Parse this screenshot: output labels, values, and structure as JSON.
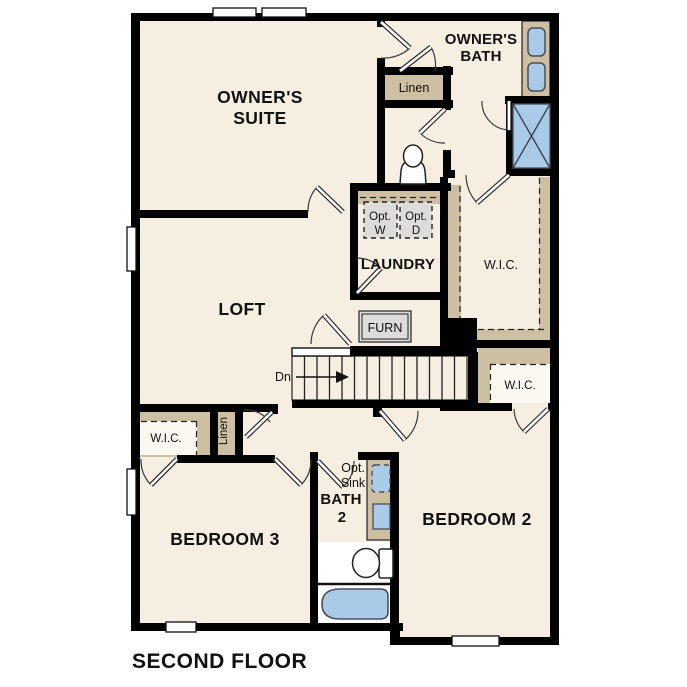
{
  "title": "SECOND FLOOR",
  "rooms": {
    "owners_suite": {
      "line1": "OWNER'S",
      "line2": "SUITE"
    },
    "owners_bath": {
      "line1": "OWNER'S",
      "line2": "BATH"
    },
    "loft": {
      "label": "LOFT"
    },
    "laundry": {
      "label": "LAUNDRY"
    },
    "bedroom2": {
      "label": "BEDROOM 2"
    },
    "bedroom3": {
      "label": "BEDROOM 3"
    },
    "bath2": {
      "line1": "BATH",
      "line2": "2"
    },
    "wic_owners": {
      "label": "W.I.C."
    },
    "wic_bedroom2": {
      "label": "W.I.C."
    },
    "wic_bedroom3": {
      "label": "W.I.C."
    },
    "linen_upper": {
      "label": "Linen"
    },
    "linen_lower": {
      "label": "Linen"
    }
  },
  "annotations": {
    "opt_washer": {
      "line1": "Opt.",
      "line2": "W"
    },
    "opt_dryer": {
      "line1": "Opt.",
      "line2": "D"
    },
    "opt_sink": {
      "line1": "Opt.",
      "line2": "Sink"
    },
    "furnace": {
      "label": "FURN"
    },
    "stairs_down": {
      "label": "Dn"
    }
  },
  "colors": {
    "floor": "#f5eee1",
    "wall": "#000000",
    "shelf": "#cdbfa2",
    "blue": "#a9cbe8",
    "gray": "#dcdcda",
    "white": "#ffffff"
  }
}
